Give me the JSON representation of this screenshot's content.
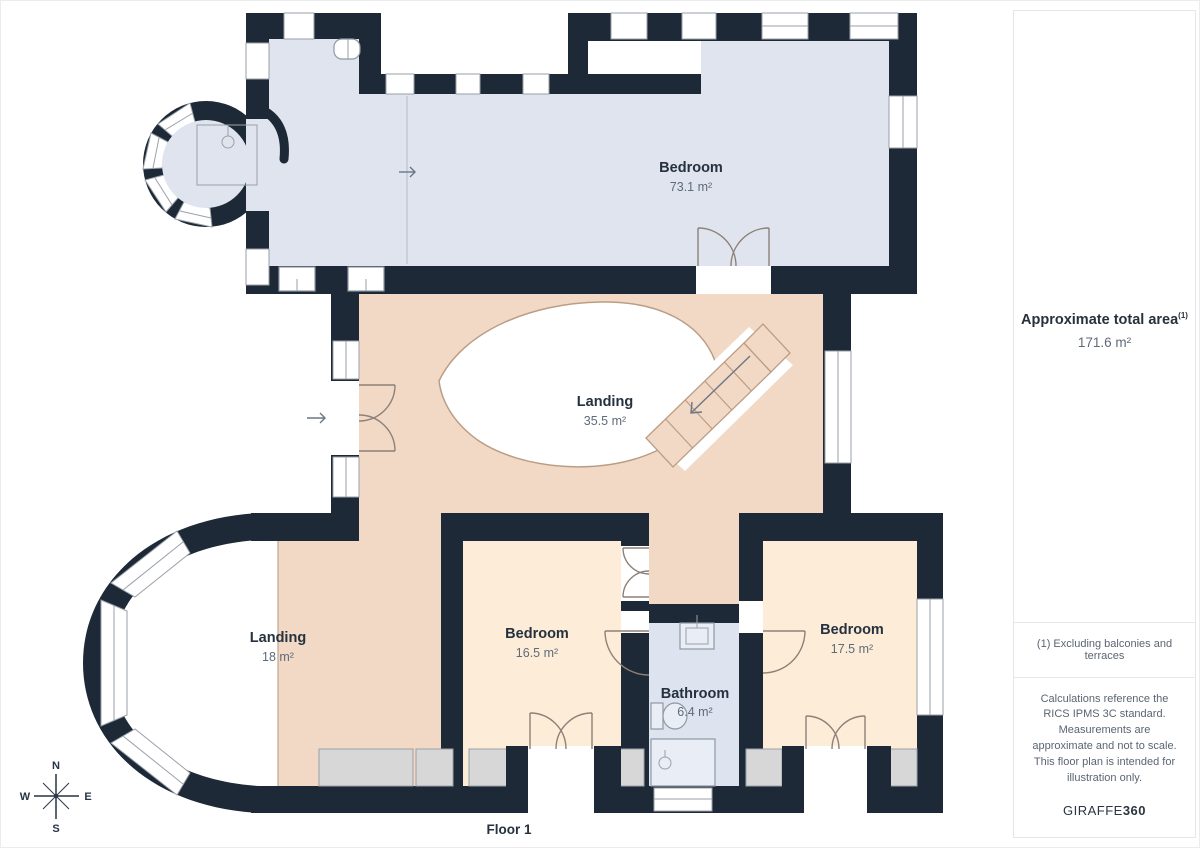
{
  "plan": {
    "rooms": [
      {
        "name": "Bedroom",
        "area": "73.1 m²"
      },
      {
        "name": "Landing",
        "area": "35.5 m²"
      },
      {
        "name": "Landing",
        "area": "18 m²"
      },
      {
        "name": "Bedroom",
        "area": "16.5 m²"
      },
      {
        "name": "Bathroom",
        "area": "6.4 m²"
      },
      {
        "name": "Bedroom",
        "area": "17.5 m²"
      }
    ],
    "floor_label": "Floor 1",
    "compass": {
      "n": "N",
      "s": "S",
      "e": "E",
      "w": "W"
    }
  },
  "sidebar": {
    "total_area_label": "Approximate total area",
    "total_area_footnote_marker": "(1)",
    "total_area_value": "171.6 m²",
    "footnote": "(1) Excluding balconies and terraces",
    "disclaimer": "Calculations reference the RICS IPMS 3C standard. Measurements are approximate and not to scale. This floor plan is intended for illustration only.",
    "brand_prefix": "GIRAFFE",
    "brand_suffix": "360"
  },
  "colors": {
    "wall": "#1d2936",
    "room-blue": "#dfe4ef",
    "room-peach": "#f1d9c6",
    "room-cream": "#fdecd8",
    "room-bath": "#dde3ef",
    "terrace": "#d7d7d7",
    "ink": "#25313e",
    "ink2": "#5e6b79"
  }
}
